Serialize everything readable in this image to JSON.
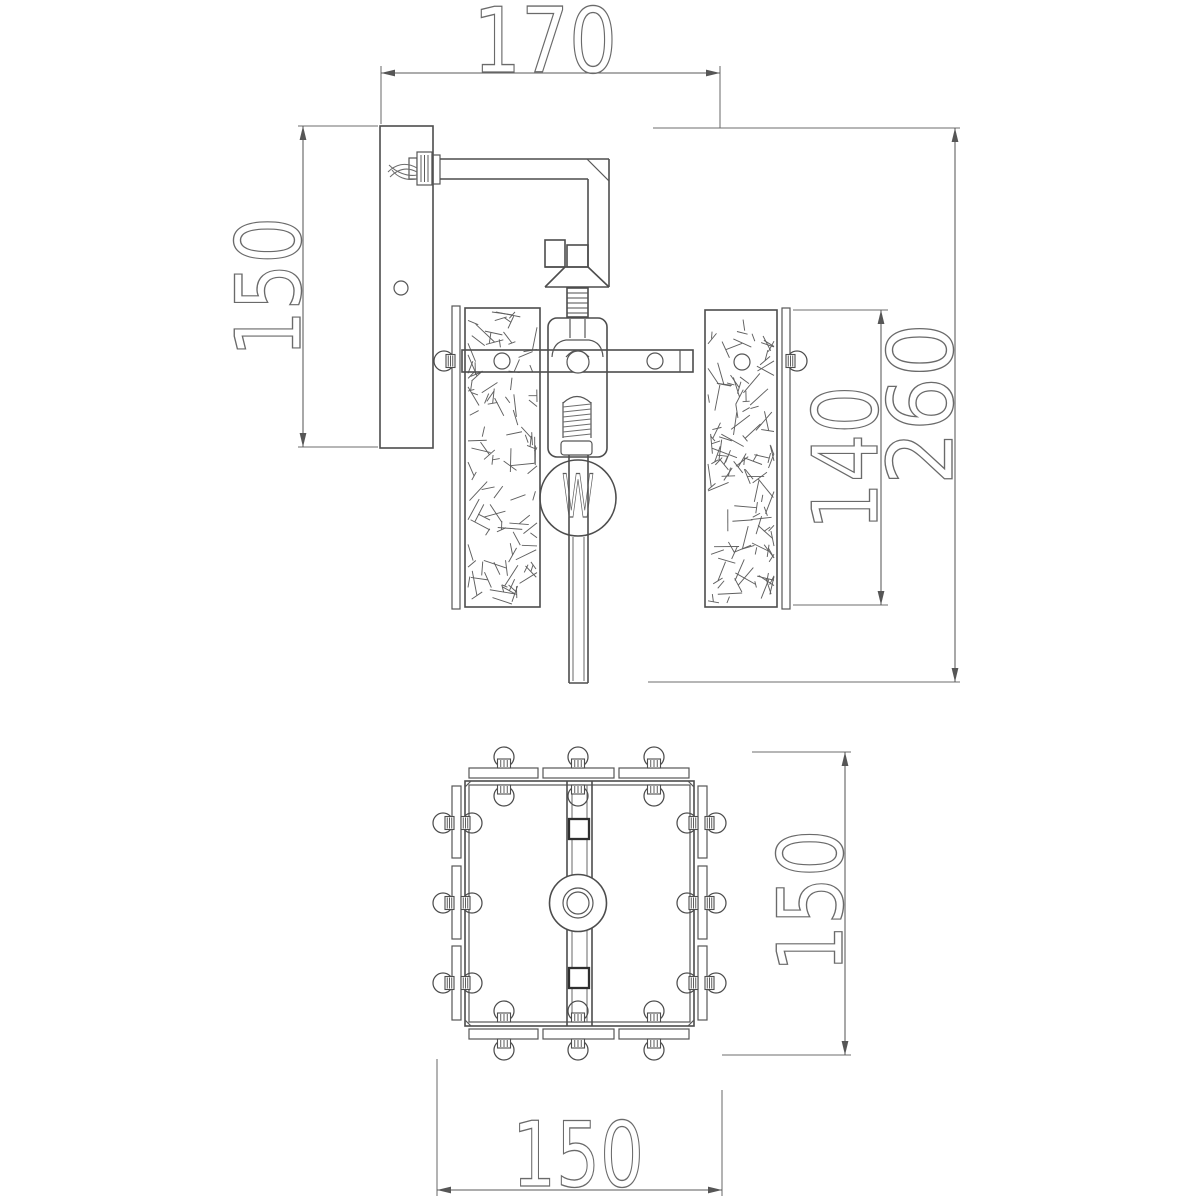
{
  "document": {
    "type": "technical-dimension-drawing",
    "background": "#ffffff"
  },
  "colors": {
    "object_line": "#4d4d4d",
    "dimension_line": "#5a5a5a",
    "text_outline": "#6a6a6a"
  },
  "side_view": {
    "dim_projection": "170",
    "dim_backplate_height": "150",
    "dim_glass_height": "140",
    "dim_total_height": "260",
    "bulb_symbol": "W"
  },
  "bottom_view": {
    "dim_depth": "150",
    "dim_width": "150"
  }
}
